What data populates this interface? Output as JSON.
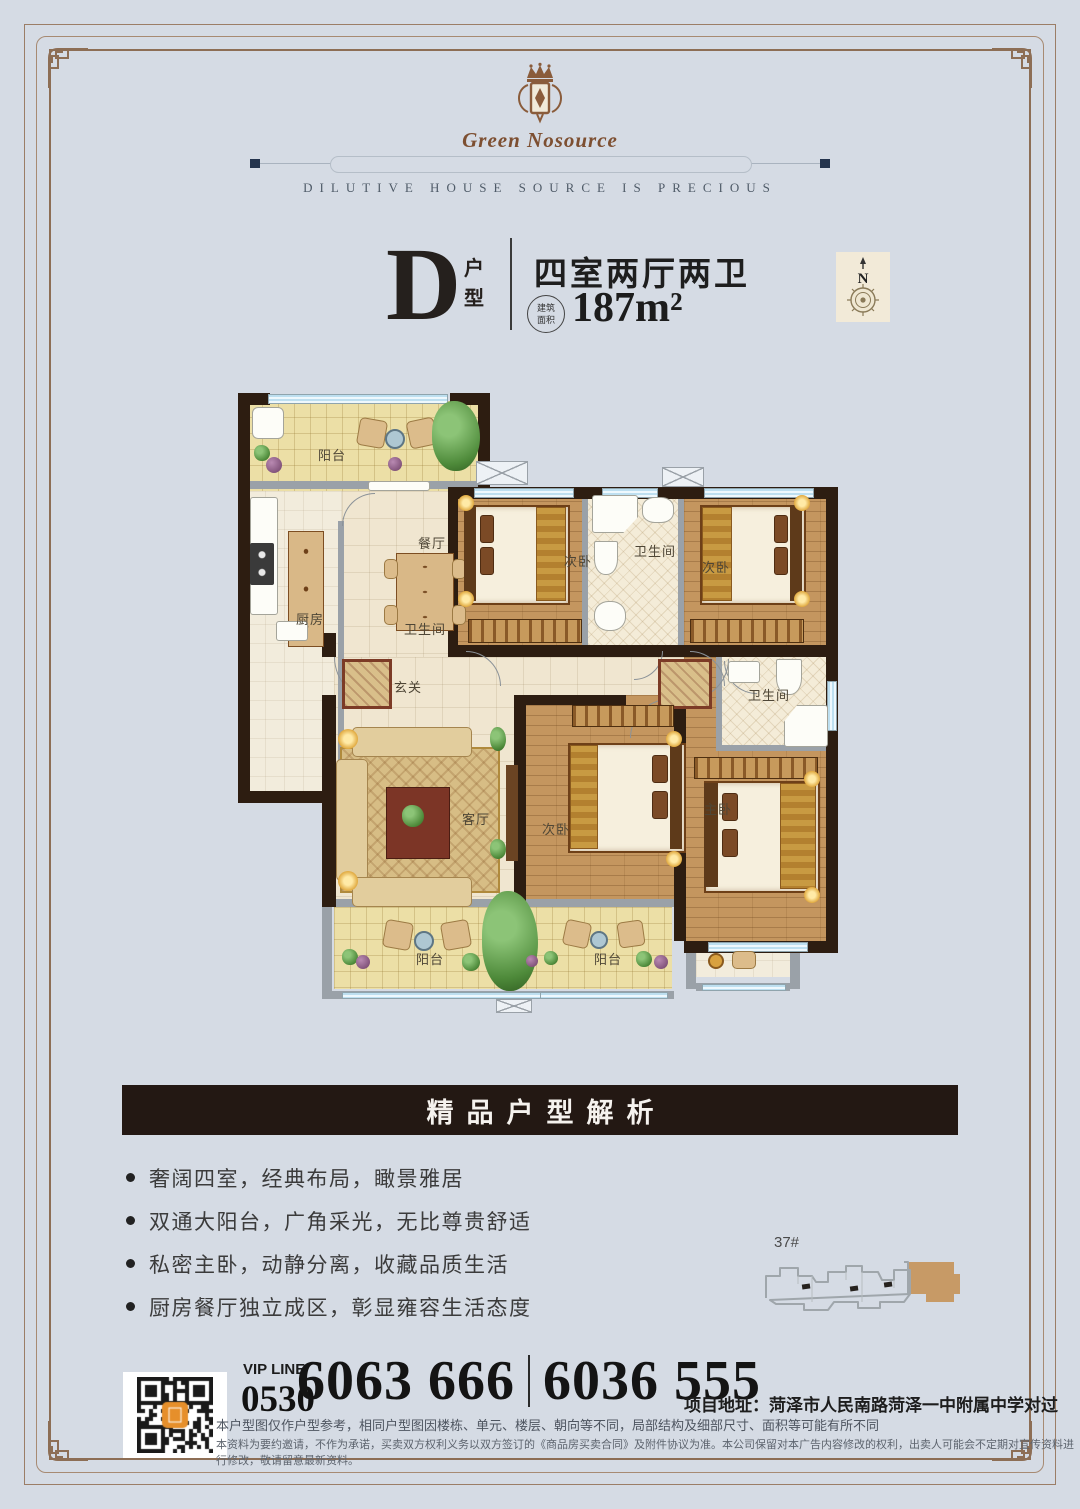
{
  "brand": {
    "logo_text": "Green Nosource",
    "tagline": "DILUTIVE HOUSE SOURCE IS PRECIOUS"
  },
  "unit": {
    "letter": "D",
    "letter_suffix_1": "户",
    "letter_suffix_2": "型",
    "layout": "四室两厅两卫",
    "area_badge_line1": "建筑",
    "area_badge_line2": "面积",
    "area_value": "187m²",
    "compass_label": "N"
  },
  "floorplan": {
    "rooms": [
      {
        "label": "阳台",
        "x": 80,
        "y": 56
      },
      {
        "label": "餐厅",
        "x": 180,
        "y": 144
      },
      {
        "label": "厨房",
        "x": 58,
        "y": 220
      },
      {
        "label": "卫生间",
        "x": 166,
        "y": 230
      },
      {
        "label": "次卧",
        "x": 326,
        "y": 162
      },
      {
        "label": "卫生间",
        "x": 396,
        "y": 152
      },
      {
        "label": "次卧",
        "x": 464,
        "y": 168
      },
      {
        "label": "玄关",
        "x": 156,
        "y": 288
      },
      {
        "label": "客厅",
        "x": 224,
        "y": 420
      },
      {
        "label": "次卧",
        "x": 304,
        "y": 430
      },
      {
        "label": "主卧",
        "x": 466,
        "y": 410
      },
      {
        "label": "卫生间",
        "x": 510,
        "y": 296
      },
      {
        "label": "阳台",
        "x": 178,
        "y": 560
      },
      {
        "label": "阳台",
        "x": 356,
        "y": 560
      }
    ]
  },
  "analysis": {
    "banner": "精品户型解析",
    "bullets": [
      "奢阔四室，经典布局，瞰景雅居",
      "双通大阳台，广角采光，无比尊贵舒适",
      "私密主卧，动静分离，收藏品质生活",
      "厨房餐厅独立成区，彰显雍容生活态度"
    ]
  },
  "keyplan": {
    "building_label": "37#",
    "highlight_color": "#c79a66"
  },
  "contact": {
    "vip_line_label": "VIP LINE",
    "area_code": "0530",
    "phone_primary": "6063 666",
    "phone_secondary": "6036 555",
    "address": "项目地址：菏泽市人民南路菏泽一中附属中学对过",
    "disclaimer_line1": "本户型图仅作户型参考，相同户型图因楼栋、单元、楼层、朝向等不同，局部结构及细部尺寸、面积等可能有所不同",
    "disclaimer_line2": "本资料为要约邀请，不作为承诺，买卖双方权利义务以双方签订的《商品房买卖合同》及附件协议为准。本公司保留对本广告内容修改的权利，出卖人可能会不定期对宣传资料进行修改，敬请留意最新资料。"
  }
}
